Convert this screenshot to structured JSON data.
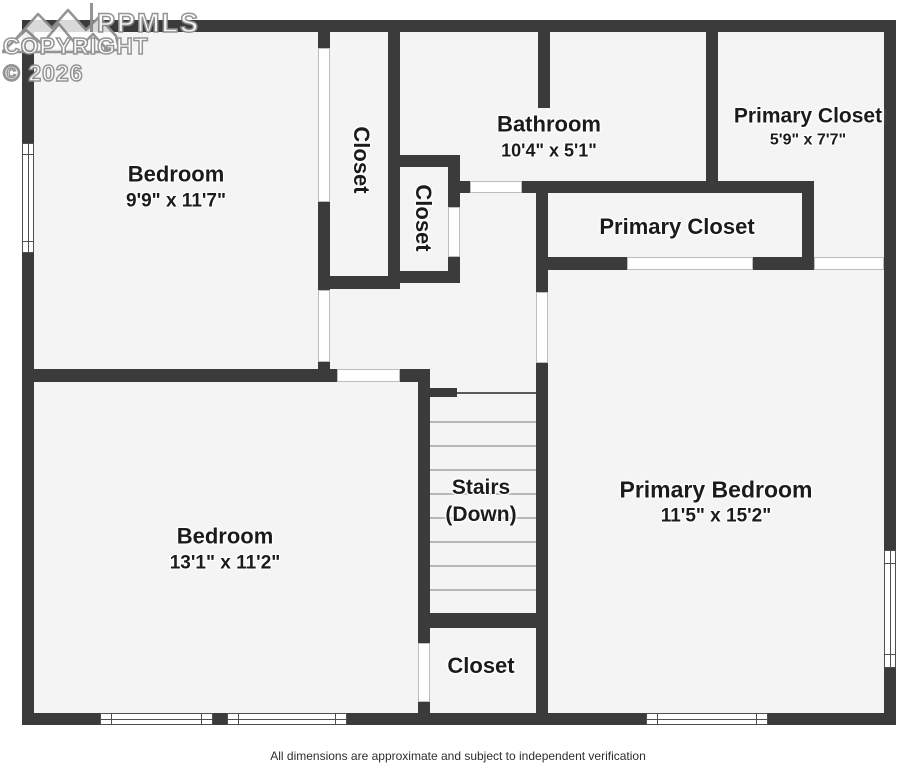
{
  "watermark": {
    "brand": "PPMLS",
    "copyright": "COPYRIGHT © 2026"
  },
  "disclaimer": "All dimensions are approximate and subject to independent verification",
  "rooms": {
    "bedroom_top": {
      "name": "Bedroom",
      "dims": "9'9\" x 11'7\""
    },
    "closet_tall": {
      "name": "Closet"
    },
    "closet_small": {
      "name": "Closet"
    },
    "bathroom": {
      "name": "Bathroom",
      "dims": "10'4\" x 5'1\""
    },
    "primary_closet_top": {
      "name": "Primary Closet",
      "dims": "5'9\" x 7'7\""
    },
    "primary_closet_mid": {
      "name": "Primary Closet"
    },
    "stairs": {
      "name": "Stairs",
      "qualifier": "(Down)"
    },
    "bedroom_bottom": {
      "name": "Bedroom",
      "dims": "13'1\" x 11'2\""
    },
    "primary_bedroom": {
      "name": "Primary Bedroom",
      "dims": "11'5\" x 15'2\""
    },
    "closet_bottom": {
      "name": "Closet"
    }
  },
  "colors": {
    "wall": "#3b3b3b",
    "floor": "#f4f4f5",
    "background": "#ffffff"
  }
}
